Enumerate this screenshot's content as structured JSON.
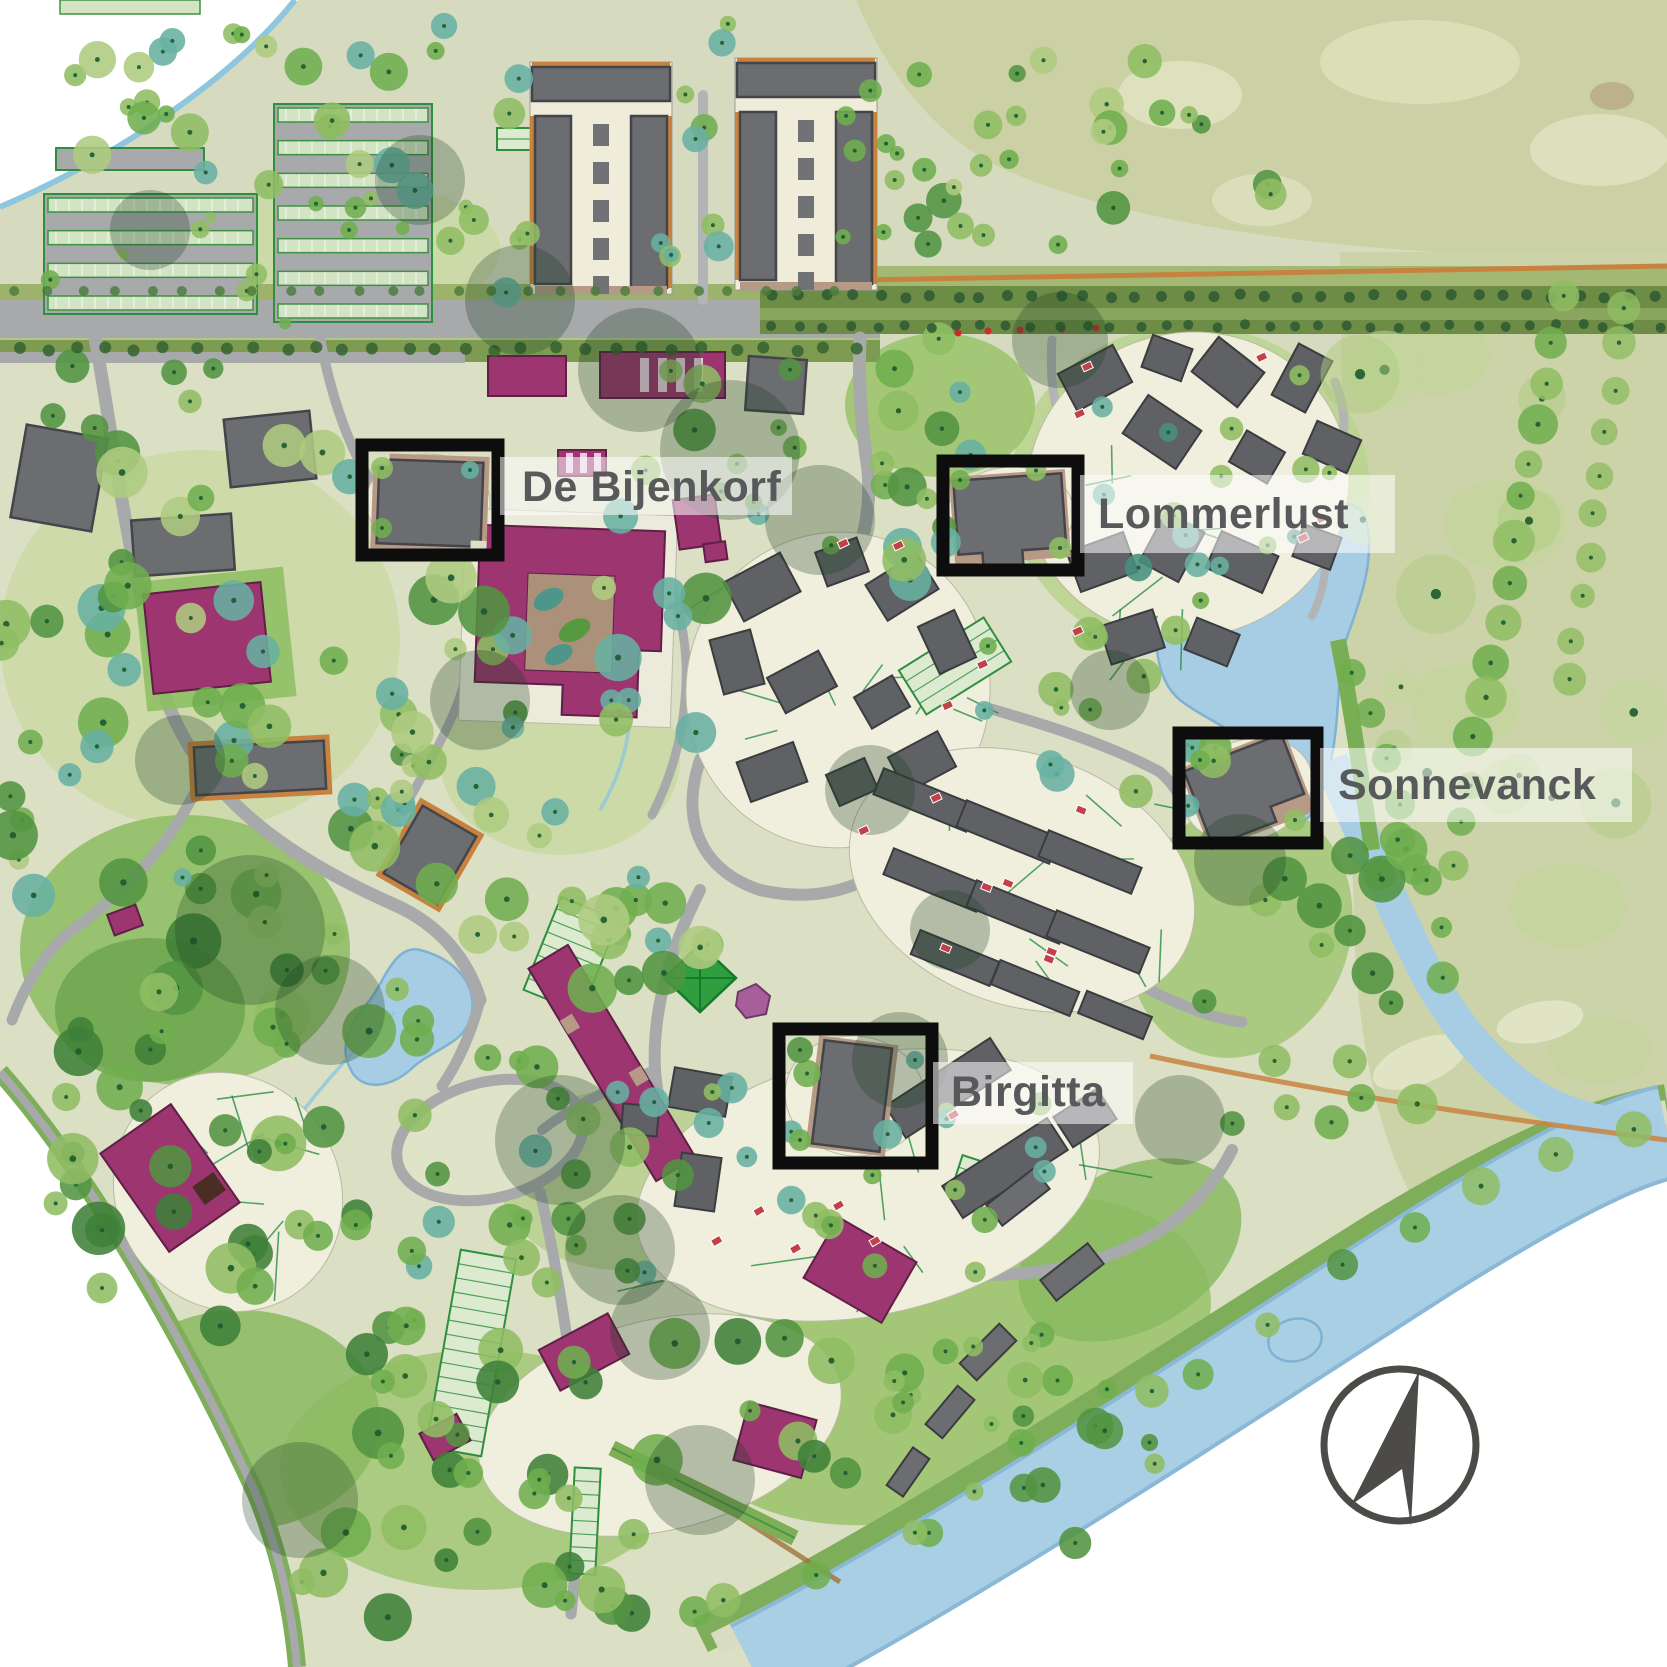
{
  "map": {
    "title": "Landscaped estate site plan",
    "annotations": [
      {
        "id": "de-bijenkorf",
        "label": "De Bijenkorf"
      },
      {
        "id": "lommerlust",
        "label": "Lommerlust"
      },
      {
        "id": "sonnevanck",
        "label": "Sonnevanck"
      },
      {
        "id": "birgitta",
        "label": "Birgitta"
      }
    ],
    "compass": {
      "type": "north-arrow"
    },
    "colors": {
      "label_text": "#58595b",
      "label_band": "rgba(255,255,255,0.55)",
      "highlight_box": "#0d0d0d",
      "base_ground": "#dbdfc4",
      "field": "#cbd1a4",
      "road": "#a7a9ab",
      "water": "#a6cde4",
      "gray_building": "#6b6d70",
      "magenta_building": "#9c3570",
      "tree_dark": "#3f8138",
      "tree_light": "#aecb7f"
    }
  }
}
